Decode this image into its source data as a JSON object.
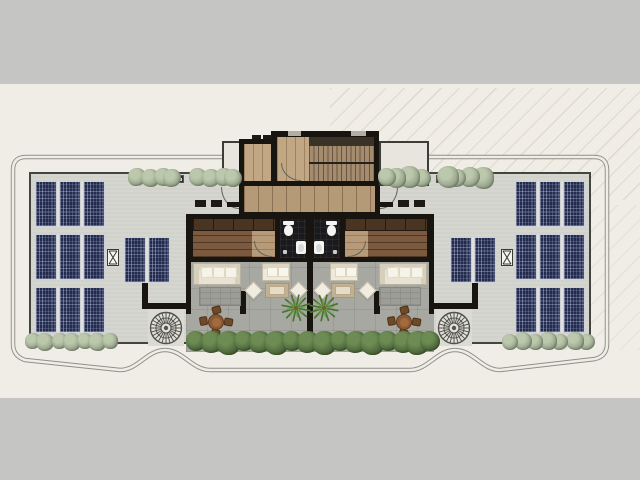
{
  "scene": {
    "type": "architectural floor plan",
    "description": "Top-down roof terrace plan of two mirrored residential units with central staircase core, bathrooms, bedrooms, terrace lounges, solar panel arrays and landscaped planters",
    "canvas": {
      "width": 640,
      "height": 480
    }
  },
  "palette": {
    "background": "#f0ede7",
    "band": "#c5c6c4",
    "slab": "#d6d6d0",
    "courtyard": "#a8a8a2",
    "wall": "#181511",
    "wood_hall": "#b59a78",
    "wood_room": "#c2a785",
    "wood_bedroom": "#7b5a40",
    "wood_closet": "#4a3522",
    "wood_accent": "#b79b79",
    "bath_tile": "#1a1a1e",
    "fixture": "#f4f4f2",
    "solar_panel": "#222b4d",
    "solar_grid": "#b9c2dd",
    "shrub_sage": "#9aa88e",
    "shrub_green": "#4f6b3b",
    "sofa": "#eae4d4",
    "rug": "#9d9d97",
    "table_wood": "#8a5a34",
    "boundary": "#8f8f88"
  },
  "solar": {
    "large_groups_per_side": 3,
    "panels_per_large_group": 3,
    "small_groups_per_side": 1,
    "panels_per_small_group": 2,
    "total_panels": 22
  },
  "core": {
    "rooms": [
      "staircase",
      "landing hall",
      "bathroom left",
      "bathroom right",
      "bedroom left",
      "bedroom right"
    ],
    "fixtures_per_bathroom": [
      "toilet",
      "washbasin",
      "floor drain"
    ]
  },
  "units": {
    "count": 2,
    "mirrored": true,
    "furniture_each": [
      "sectional sofa",
      "area rug",
      "loveseat",
      "two lounge cushions",
      "coffee table on mat",
      "round dining table",
      "four chairs",
      "palm plant"
    ]
  },
  "landscape": {
    "top_shrub_clusters": 4,
    "bushes_per_top_cluster": 4,
    "bottom_center_bushes": 16,
    "bottom_wing_bushes_per_side": 7,
    "spiral_features": 2,
    "roof_hatch_markers": 2,
    "drain_markers": 2
  }
}
